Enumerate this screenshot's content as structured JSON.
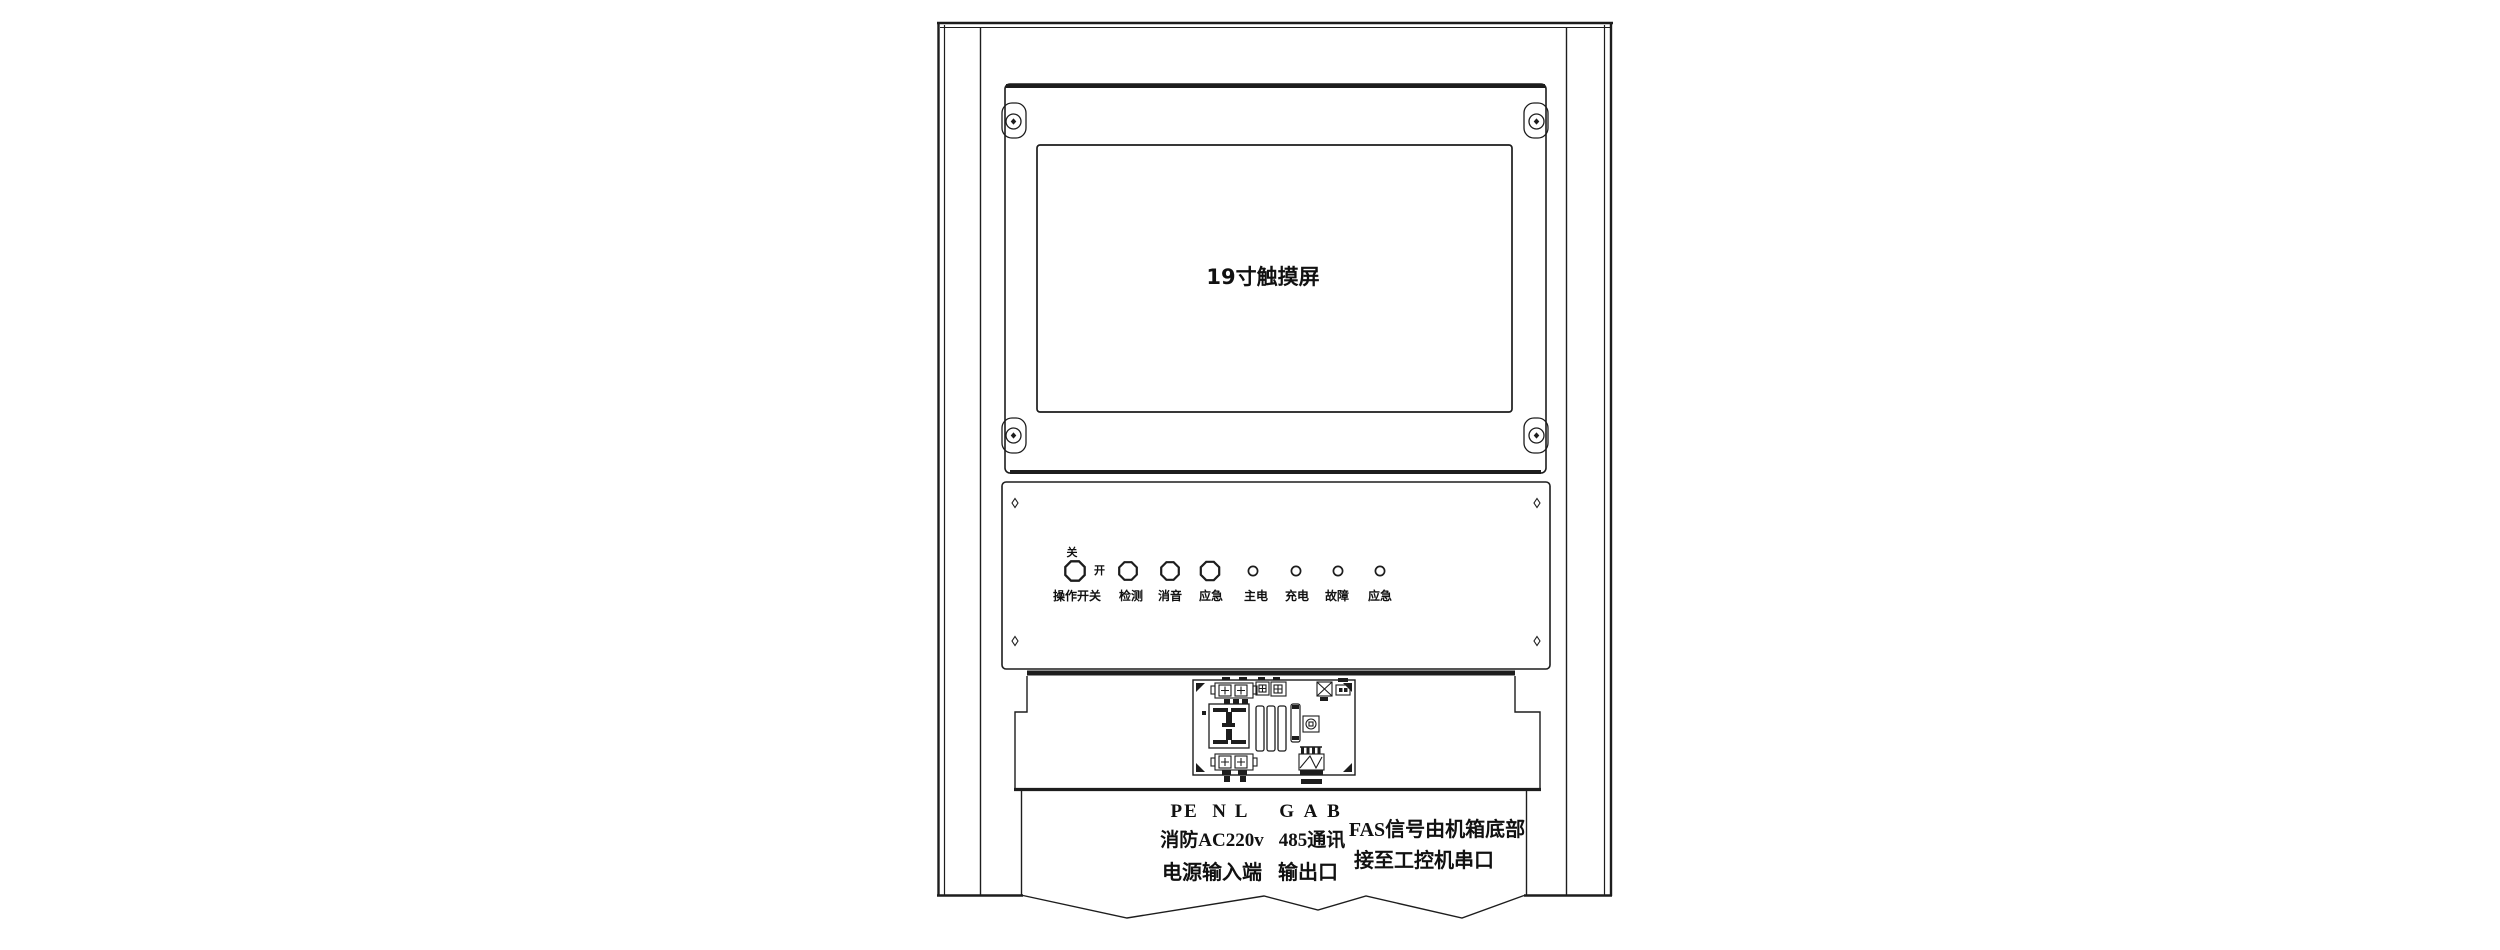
{
  "diagram": {
    "screen_label": "19寸触摸屏",
    "control_panel": {
      "switch_off": "关",
      "switch_on": "开",
      "buttons": [
        "操作开关",
        "检测",
        "消音",
        "应急"
      ],
      "leds": [
        "主电",
        "充电",
        "故障",
        "应急"
      ]
    },
    "terminals": {
      "power": {
        "pins": "PE  N L",
        "line1": "消防AC220v",
        "line2": "电源输入端"
      },
      "comm": {
        "pins": "G A B",
        "line1": "485通讯",
        "line2": "输出口"
      },
      "fas": {
        "line1": "FAS信号由机箱底部",
        "line2": "接至工控机串口"
      }
    },
    "colors": {
      "line": "#1d1d1d",
      "background": "#ffffff"
    }
  }
}
